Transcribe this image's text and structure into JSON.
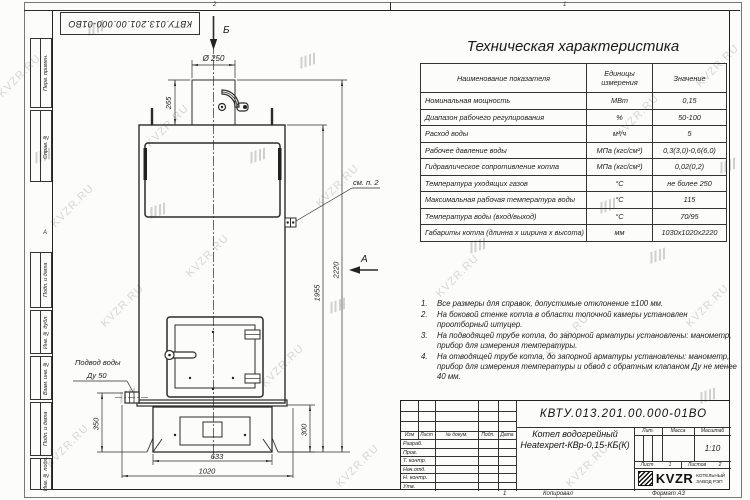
{
  "watermark": {
    "text": "KVZR.RU"
  },
  "sheet": {
    "zone_numbers": {
      "n2": "2",
      "n1": "1"
    },
    "zone_letter_a": "А",
    "designation_flipped": "КВТУ.013.201.00.000-01ВО",
    "left_stamps": {
      "s1": "Перв. примен.",
      "s2": "Справ. №",
      "s3": "Подп. и дата",
      "s4": "Инв. № дубл.",
      "s5": "Взам. инв. №",
      "s6": "Подп. и дата",
      "s7": "Инв. № подл."
    }
  },
  "spec_table": {
    "title": "Техническая характеристика",
    "col_name": "Наименование показателя",
    "col_units": "Единицы измерения",
    "col_value": "Значение",
    "rows": [
      {
        "name": "Номинальная мощность",
        "units": "МВт",
        "value": "0,15"
      },
      {
        "name": "Диапазон рабочего регулирования",
        "units": "%",
        "value": "50-100"
      },
      {
        "name": "Расход воды",
        "units": "м³/ч",
        "value": "5"
      },
      {
        "name": "Рабочее давление воды",
        "units": "МПа (кгс/см²)",
        "value": "0,3(3,0)-0,6(6,0)"
      },
      {
        "name": "Гидравлическое сопротивление котла",
        "units": "МПа (кгс/см²)",
        "value": "0,02(0,2)"
      },
      {
        "name": "Температура уходящих газов",
        "units": "°С",
        "value": "не более 250"
      },
      {
        "name": "Максимальная рабочая температура воды",
        "units": "°С",
        "value": "115"
      },
      {
        "name": "Температура воды (вход/выход)",
        "units": "°С",
        "value": "70/95"
      },
      {
        "name": "Габариты котла (длинна х ширина х высота)",
        "units": "мм",
        "value": "1030х1020х2220"
      }
    ]
  },
  "notes": {
    "items": [
      {
        "num": "1.",
        "text": "Все размеры для справок, допустимые отклонение ±100 мм."
      },
      {
        "num": "2.",
        "text": "На боковой стенке котла в области топочной камеры установлен проотборный штуцер."
      },
      {
        "num": "3.",
        "text": "На подводящей трубе котла, до запорной арматуры установлены: манометр, прибор для измерения температуры."
      },
      {
        "num": "4.",
        "text": "На отводящей трубе котла, до запорной арматуры установлены: манометр, прибор для измерения температуры и обвод с обратным клапаном Ду не менее 40 мм."
      }
    ]
  },
  "drawing": {
    "view_b": "Б",
    "view_a": "А",
    "dia_250": "Ø 250",
    "dim_265": "265",
    "dim_1955": "1955",
    "dim_2220": "2220",
    "dim_350": "350",
    "dim_300": "300",
    "dim_633": "633",
    "dim_1020": "1020",
    "see_note": "см. п. 2",
    "inlet_line1": "Подвод воды",
    "inlet_line2": "Ду 50"
  },
  "title_block": {
    "designation": "КВТУ.013.201.00.000-01ВО",
    "product_line1": "Котел водогрейный",
    "product_line2": "Heatexpert-КВр-0,15-КБ(К)",
    "cols": {
      "izm": "Изм",
      "list": "Лист",
      "doc": "№ докум.",
      "podp": "Подп.",
      "data": "Дата"
    },
    "rows": {
      "r1": "Разраб.",
      "r2": "Пров.",
      "r3": "Т. контр.",
      "r4": "Нач.отд.",
      "r5": "Н. контр.",
      "r6": "Утв."
    },
    "lit": "Лит.",
    "mass": "Масса",
    "scale": "Масштаб",
    "scale_value": "1:10",
    "sheet": "Лист",
    "sheet_no": "1",
    "sheets": "Листов",
    "sheets_no": "2",
    "logo": "KVZR",
    "logo_sub": "КОТЕЛЬНЫЙ ЗАВОД РЭП",
    "copied": "Копировал",
    "format": "Формат А3",
    "page_mark": "1"
  }
}
